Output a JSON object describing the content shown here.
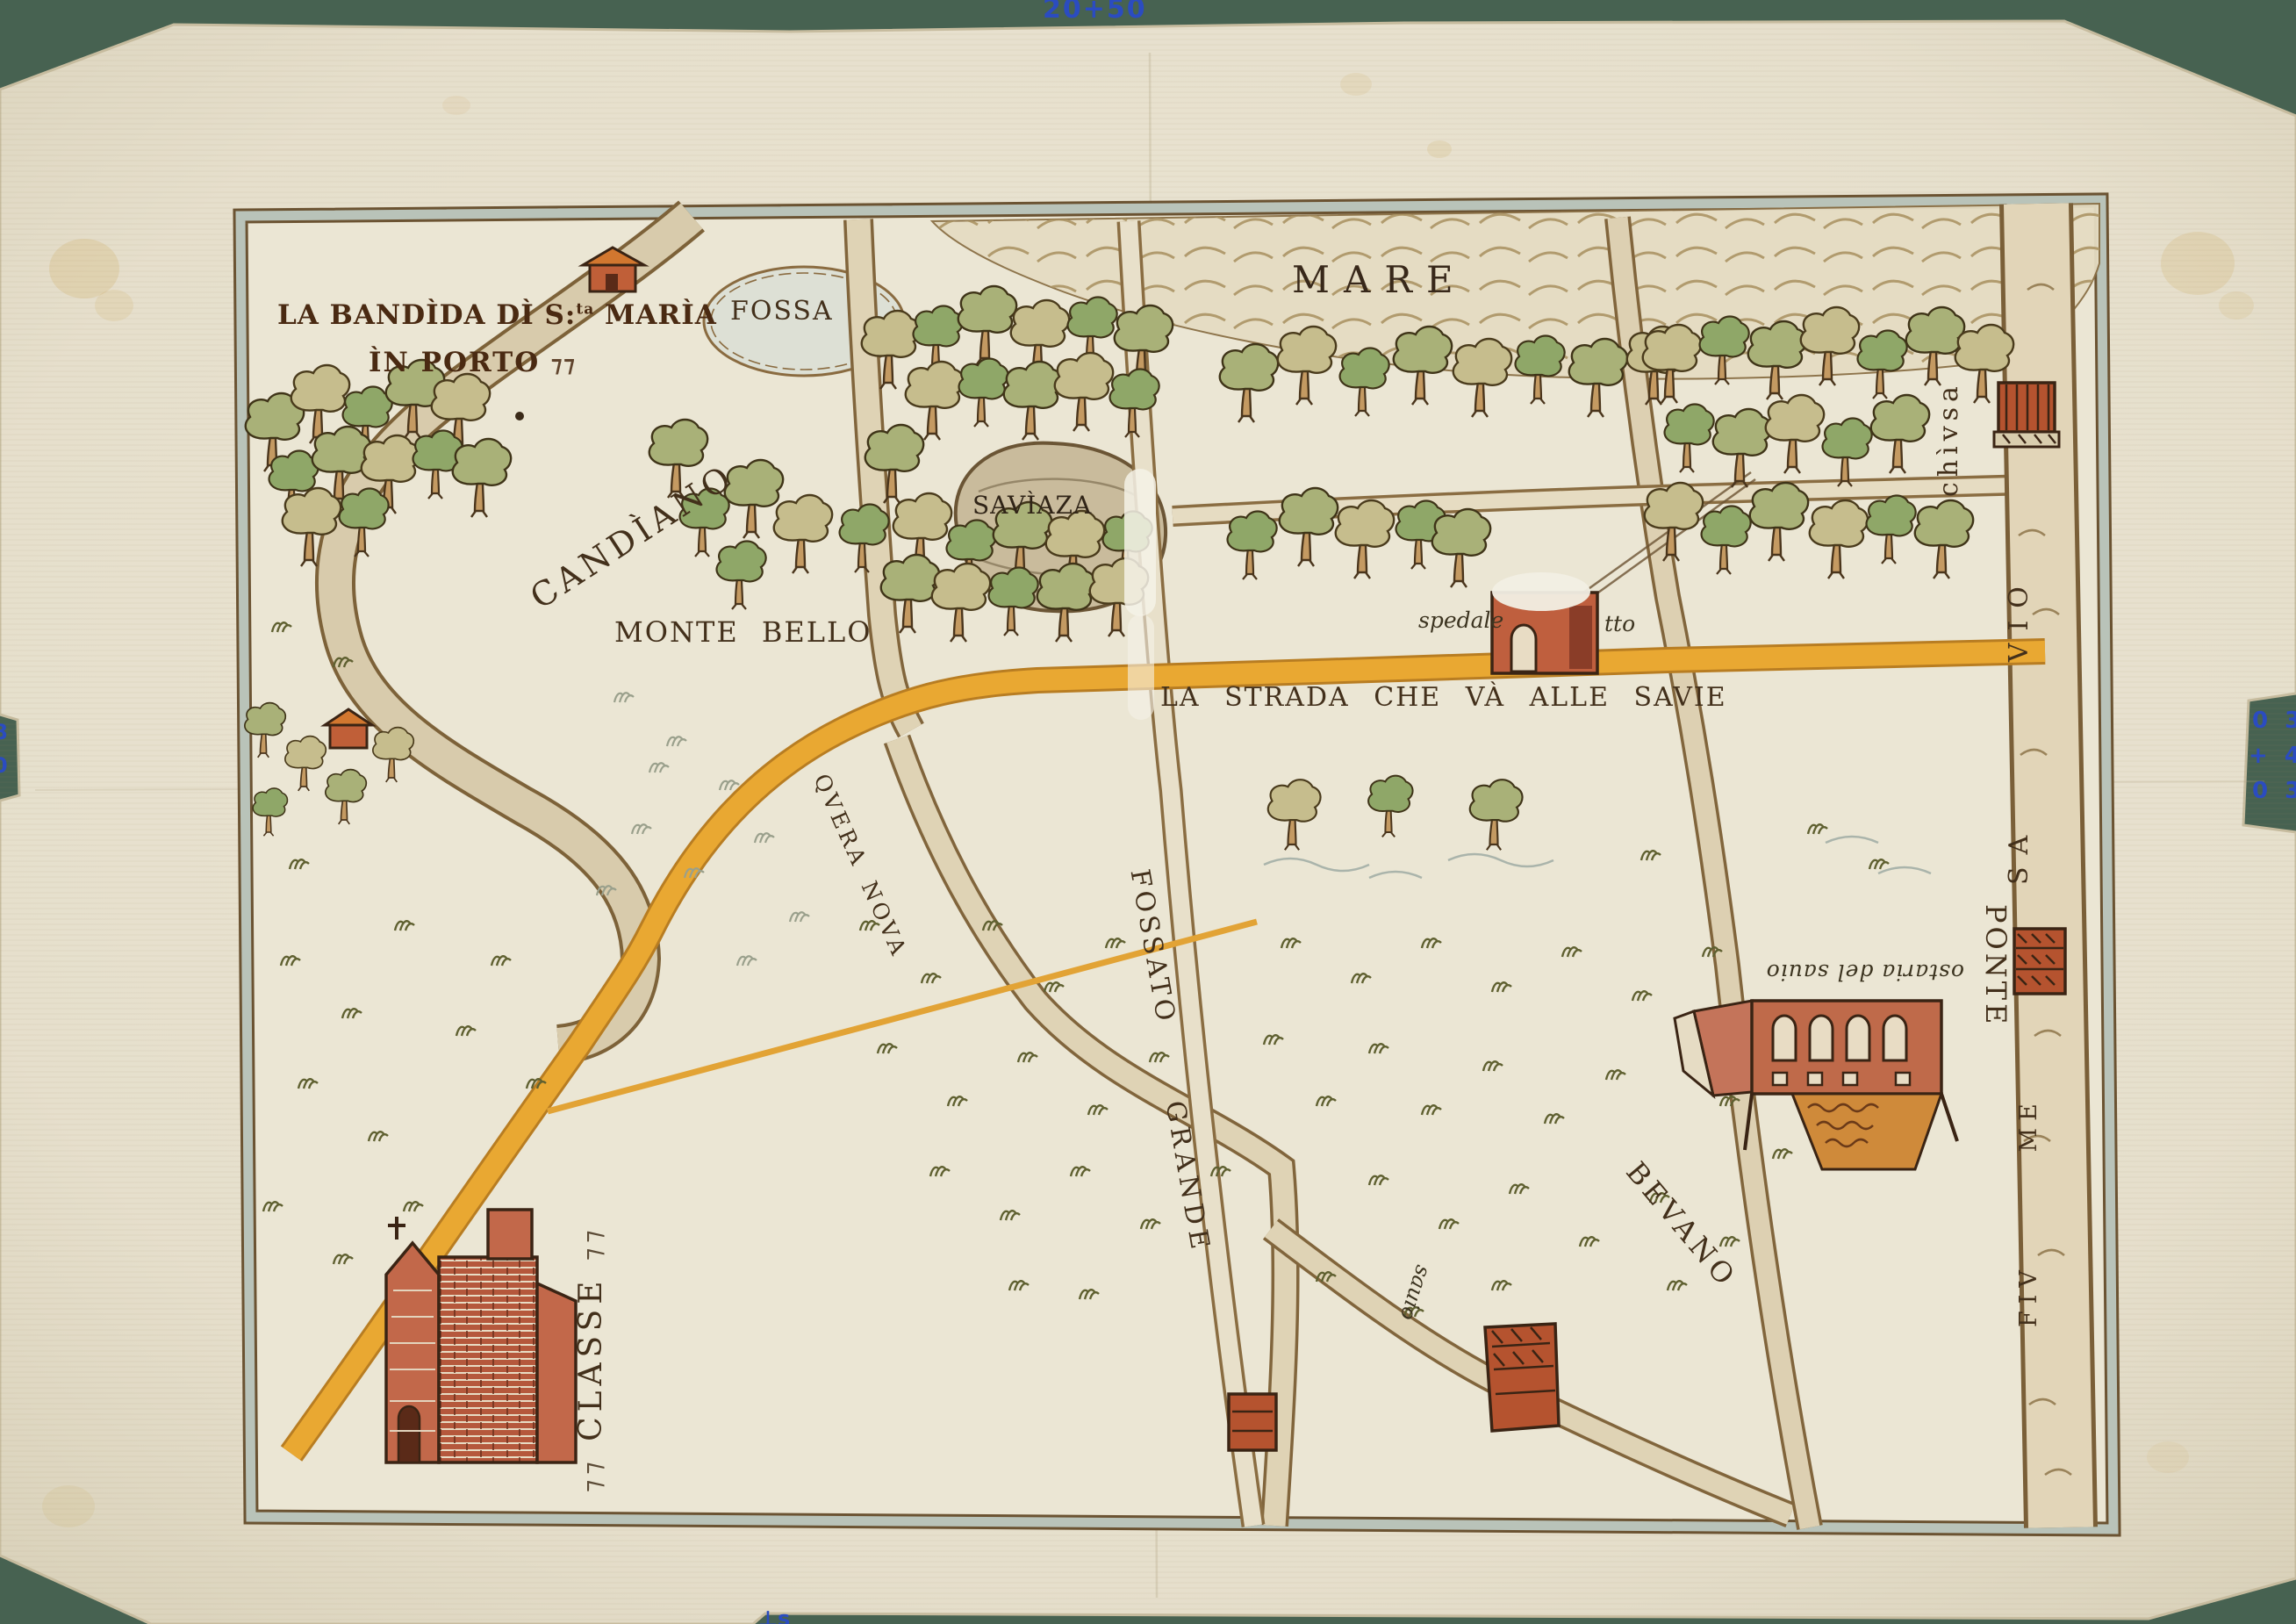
{
  "annotations": {
    "top_mark": "20+50",
    "right_marks": [
      "0 3",
      "+ 4",
      "0 3"
    ],
    "left_marks": [
      "8",
      "0"
    ],
    "bottom_mark": "⊥s"
  },
  "map": {
    "title": {
      "line1_main": "LA BANDÌDA DÌ S:",
      "line1_sup": "ta",
      "line1_rest": " MARÌA",
      "line2": "ÌN PORTO",
      "flourish": "⁊⁊"
    },
    "labels": {
      "mare": "MARE",
      "fossa": "FOSSA",
      "saviaza": "SAVÌAZA",
      "candiano": "CANDÌANO",
      "monte_bello": "MONTE BELLO",
      "strada": "LA STRADA CHE VÀ ALLE SAVIE",
      "spedale": "spedale",
      "spedale_suffix": "tto",
      "chivsa": "chìvsa",
      "quera_nova": "QVERA NOVA",
      "fossato": "FOSSATO",
      "grande": "GRANDE",
      "bevano": "BEVANO",
      "ponte": "PONTE",
      "osteria": "ostaria del sauio",
      "classe": "CLASSE",
      "savio_upper": "SA VIO",
      "savio_lower": "FIV ME",
      "savio_old": "sauio"
    }
  }
}
